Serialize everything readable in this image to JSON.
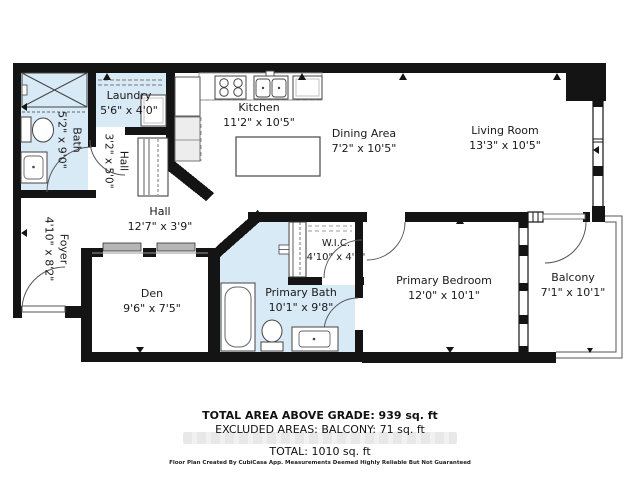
{
  "rooms": {
    "bath": {
      "name": "Bath",
      "dims": "5'2\" x 9'0\""
    },
    "laundry": {
      "name": "Laundry",
      "dims": "5'6\" x 4'0\""
    },
    "hall_small": {
      "name": "Hall",
      "dims": "3'2\" x 5'0\""
    },
    "kitchen": {
      "name": "Kitchen",
      "dims": "11'2\" x 10'5\""
    },
    "dining": {
      "name": "Dining Area",
      "dims": "7'2\" x 10'5\""
    },
    "living": {
      "name": "Living Room",
      "dims": "13'3\" x 10'5\""
    },
    "hall": {
      "name": "Hall",
      "dims": "12'7\" x 3'9\""
    },
    "foyer": {
      "name": "Foyer",
      "dims": "4'10\" x 8'2\""
    },
    "den": {
      "name": "Den",
      "dims": "9'6\" x 7'5\""
    },
    "wic": {
      "name": "W.I.C.",
      "dims": "4'10\" x 4'6\""
    },
    "primary_bath": {
      "name": "Primary Bath",
      "dims": "10'1\" x 9'8\""
    },
    "primary_bedroom": {
      "name": "Primary Bedroom",
      "dims": "12'0\" x 10'1\""
    },
    "balcony": {
      "name": "Balcony",
      "dims": "7'1\" x 10'1\""
    }
  },
  "summary": {
    "total_above_grade": "TOTAL AREA ABOVE GRADE: 939 sq. ft",
    "excluded_areas": "EXCLUDED AREAS: BALCONY: 71 sq. ft",
    "total": "TOTAL: 1010 sq. ft",
    "disclaimer": "Floor Plan Created By CubiCasa App. Measurements Deemed Highly Reliable But Not Guaranteed"
  },
  "colors": {
    "wall": "#141414",
    "wet_room_fill": "#d8eaf6",
    "slider_panel": "#b5b5b5"
  }
}
